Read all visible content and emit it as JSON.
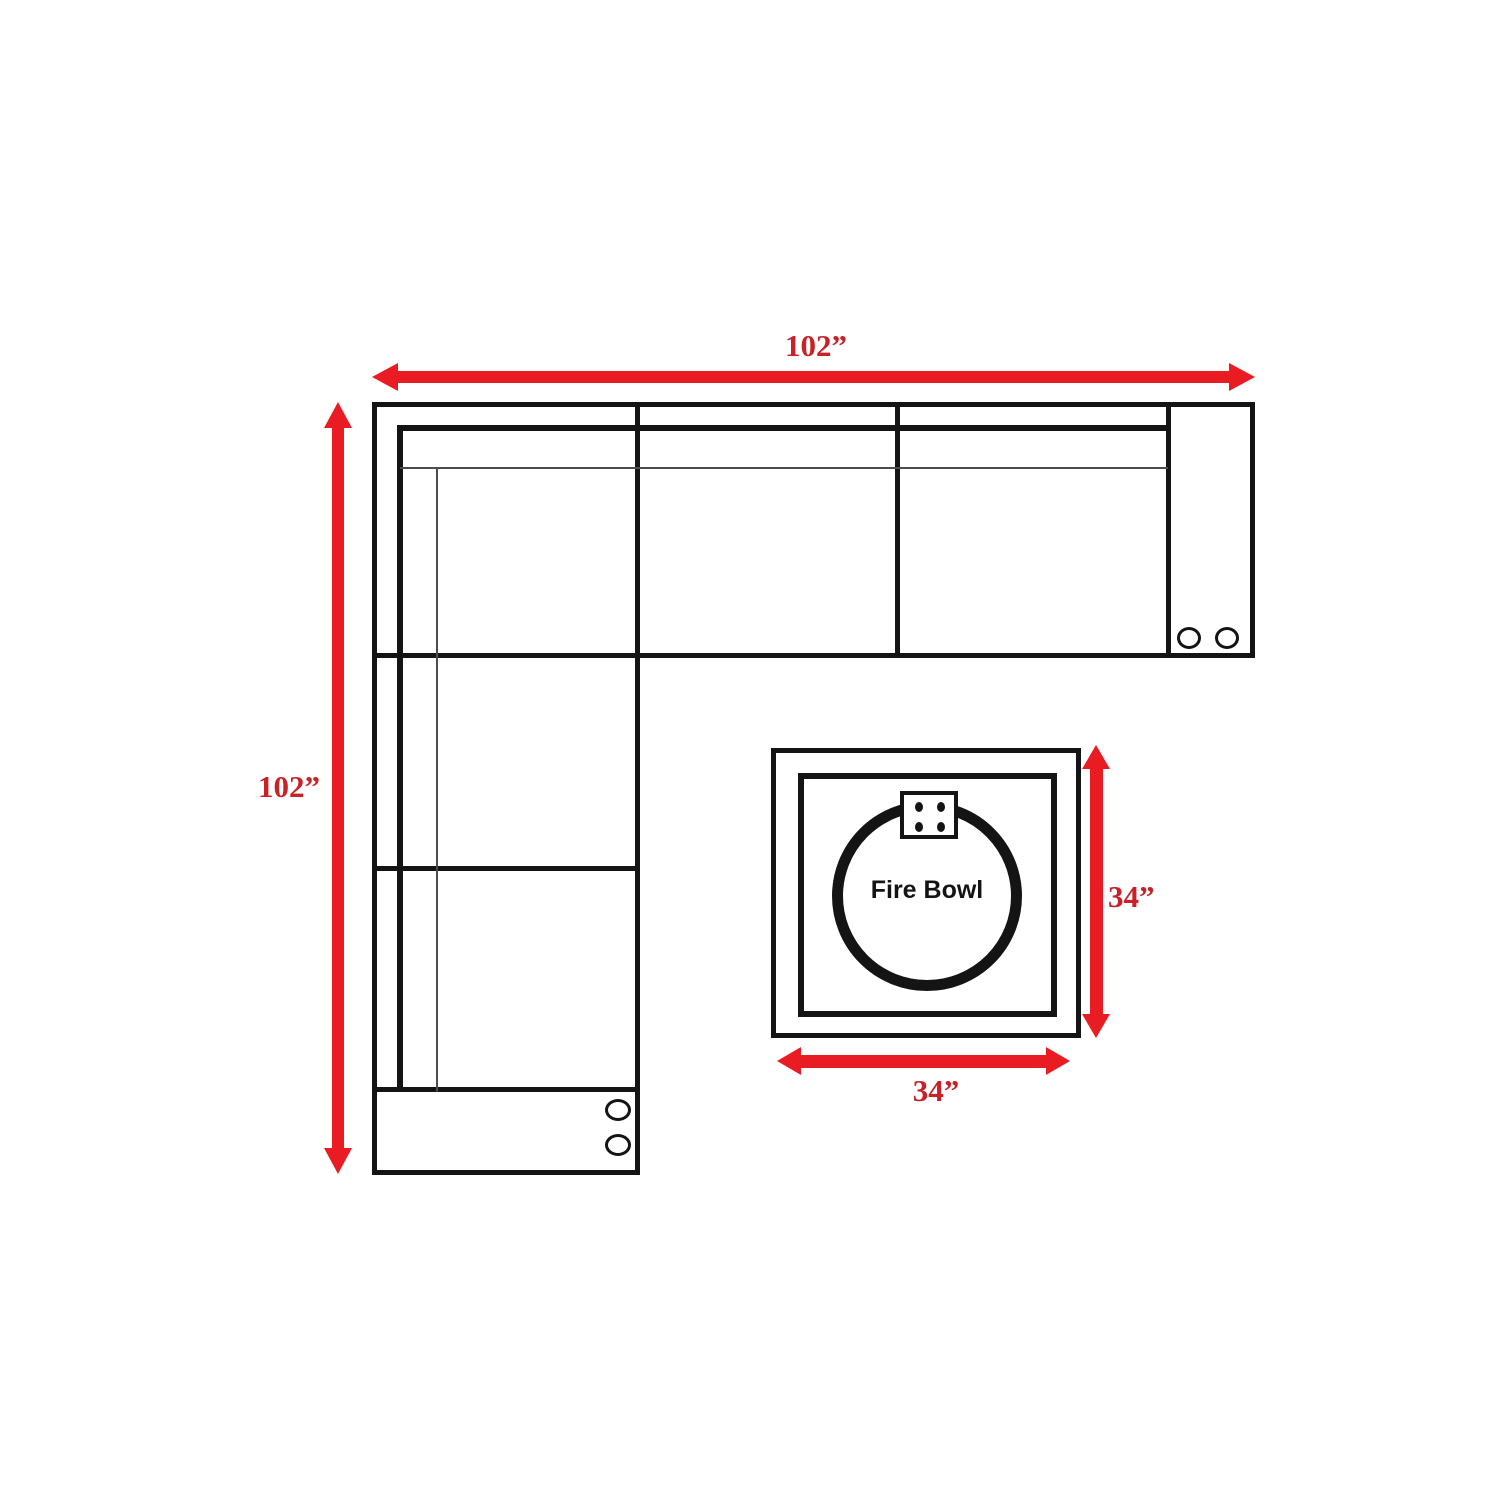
{
  "labels": {
    "sofa_width": "102”",
    "sofa_depth": "102”",
    "table_height": "34”",
    "table_width": "34”",
    "fire_bowl": "Fire Bowl"
  },
  "colors": {
    "arrow_red": "#e81c22",
    "label_red": "#c82127",
    "line_black": "#141414",
    "background": "#ffffff"
  }
}
